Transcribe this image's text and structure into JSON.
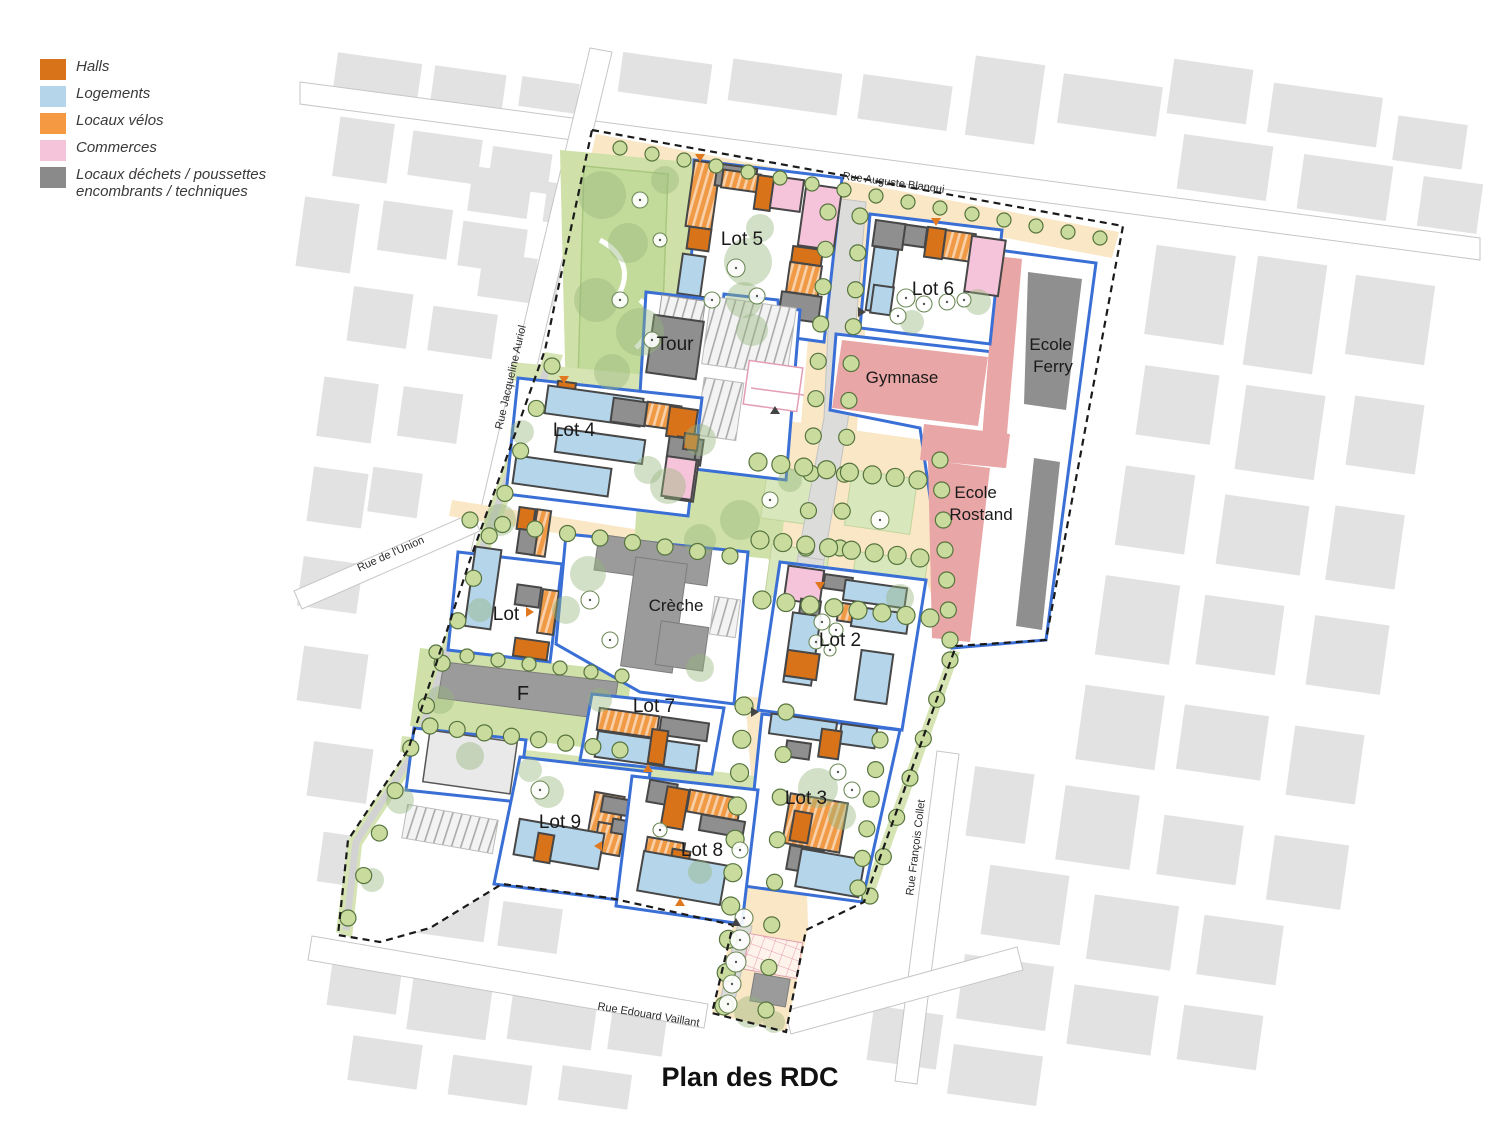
{
  "title": "Plan des RDC",
  "legend": {
    "items": [
      {
        "label": "Halls",
        "color": "#d9731a"
      },
      {
        "label": "Logements",
        "color": "#b5d5ea"
      },
      {
        "label": "Locaux vélos",
        "color": "#f59a42"
      },
      {
        "label": "Commerces",
        "color": "#f6c4da"
      },
      {
        "label": "Locaux déchets / poussettes encombrants / techniques",
        "color": "#8a8a8a"
      }
    ]
  },
  "map": {
    "streets": [
      {
        "name": "Rue Auguste Blanqui"
      },
      {
        "name": "Rue Jacqueline Auriol"
      },
      {
        "name": "Rue de l'Union"
      },
      {
        "name": "Rue François Collet"
      },
      {
        "name": "Rue Edouard Vaillant"
      }
    ],
    "labels": {
      "lot5": "Lot 5",
      "lot6": "Lot 6",
      "tour": "Tour",
      "lot4": "Lot 4",
      "gymnase": "Gymnase",
      "ecole_ferry": {
        "l1": "Ecole",
        "l2": "Ferry"
      },
      "ecole_rostand": {
        "l1": "Ecole",
        "l2": "Rostand"
      },
      "lot1": "Lot",
      "creche": "Crèche",
      "lot2": "Lot 2",
      "f": "F",
      "lot7": "Lot 7",
      "lot3": "Lot 3",
      "lot9": "Lot 9",
      "lot8": "Lot 8"
    },
    "colors": {
      "lot_border": "#3a6fd6",
      "school": "#e9a6a6",
      "park_green": "#cfe1a8",
      "plaza_beige": "#fae7c5",
      "context_gray": "#e2e2e2"
    }
  }
}
